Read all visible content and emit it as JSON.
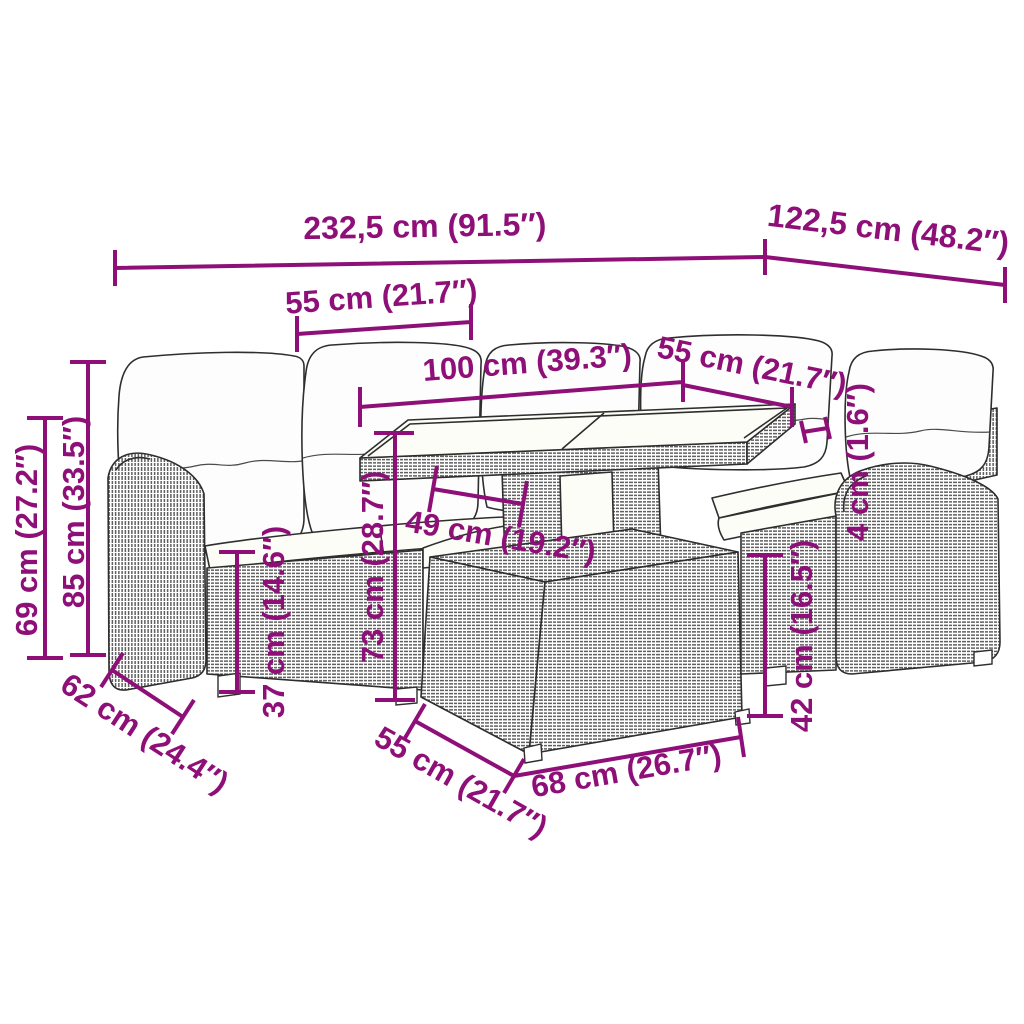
{
  "diagram": {
    "accent_color": "#8E0F78",
    "line_color": "#2e2e2e",
    "subject": "rattan-garden-lounge-set-with-table-dimension-diagram",
    "dims": {
      "overall_width": "232,5 cm (91.5″)",
      "overall_depth": "122,5 cm (48.2″)",
      "left_seat_width": "55 cm (21.7″)",
      "table_length": "100 cm (39.3″)",
      "right_seat_width": "55 cm (21.7″)",
      "glass_thickness": "4 cm (1.6″)",
      "right_seat_height": "42 cm (16.5″)",
      "left_seat_height": "37 cm (14.6″)",
      "table_height": "73 cm (28.7″)",
      "table_top_depth": "49 cm (19.2″)",
      "backrest_height": "85 cm (33.5″)",
      "armrest_height": "69 cm (27.2″)",
      "seat_depth": "62 cm (24.4″)",
      "table_base_depth": "55 cm (21.7″)",
      "table_base_width": "68 cm (26.7″)"
    }
  }
}
